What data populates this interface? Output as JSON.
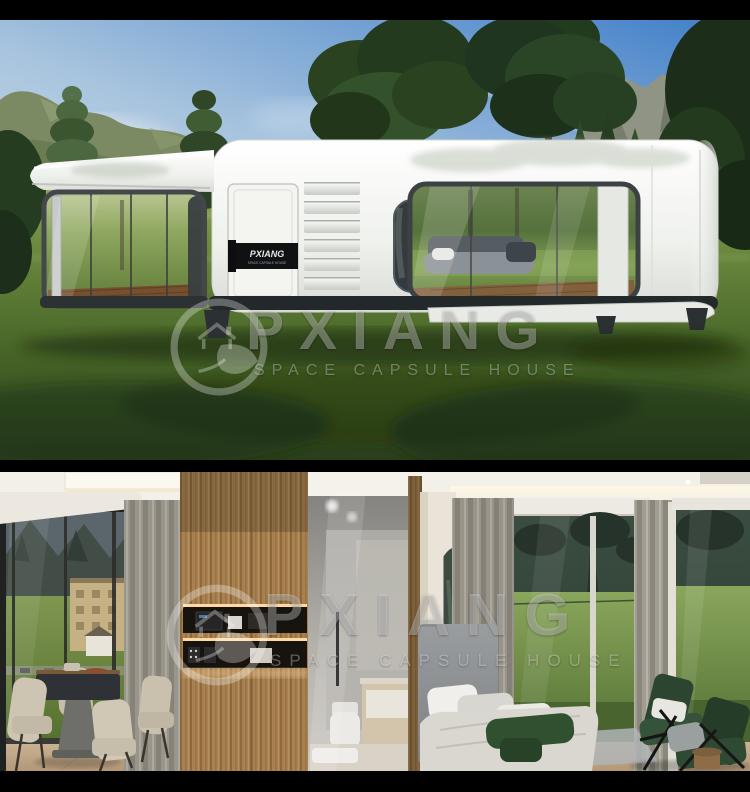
{
  "brand": {
    "name": "PXIANG",
    "tagline": "SPACE CAPSULE HOUSE"
  },
  "exterior": {
    "label": "exterior view",
    "door_plate": {
      "brand": "PXIANG",
      "subtext": "SPACE CAPSULE HOUSE"
    }
  },
  "interior": {
    "label": "interior view"
  },
  "colors": {
    "letterbox": "#000000",
    "sky_top": "#3f7ec8",
    "sky_low": "#d5e2ec",
    "grass_light": "#9fae66",
    "grass_dark": "#2a3e19",
    "house_body": "#f2f3ef",
    "window_frame": "#3c4244",
    "door_plate": "#101113",
    "wood_panel": "#a8814f",
    "curtain": "#a19d92",
    "meadow": "#86a25c",
    "chair_green": "#2c4530",
    "watermark": "rgba(255,255,255,0.32)"
  }
}
